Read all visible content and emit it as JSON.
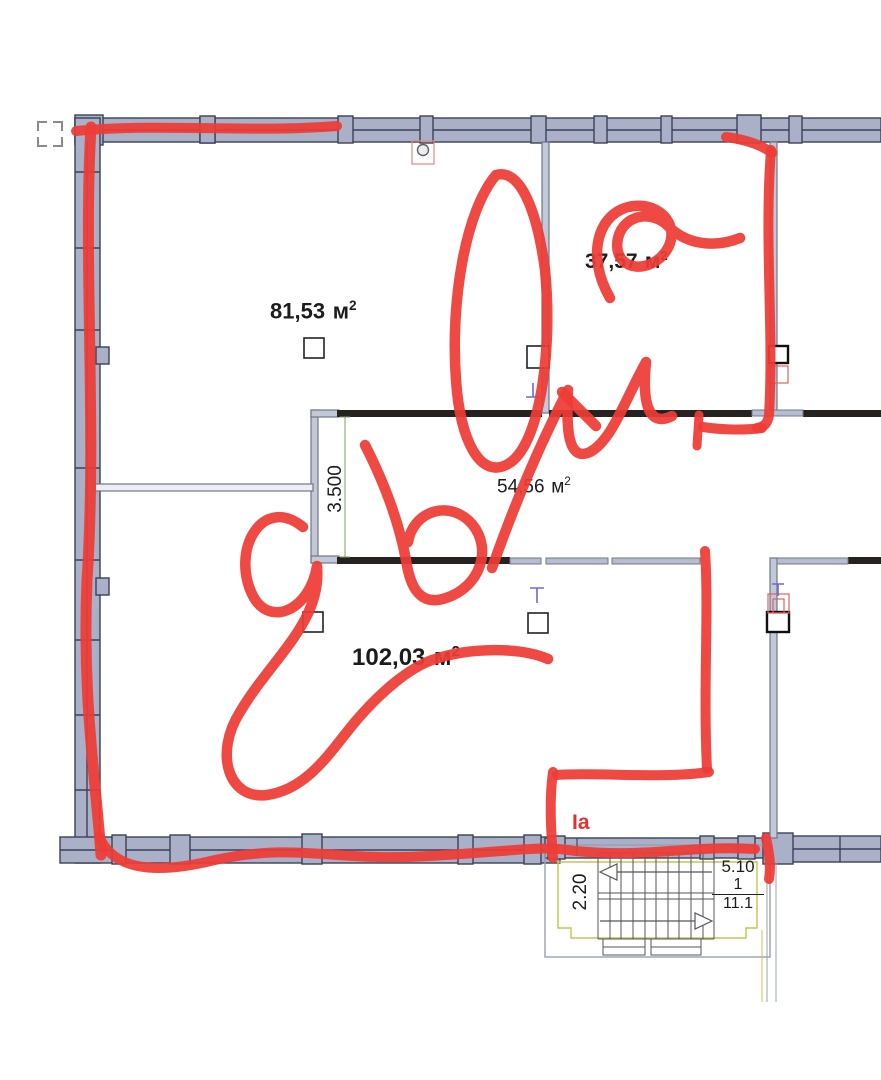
{
  "plan": {
    "unit": {
      "base": "м",
      "exp": "2"
    },
    "rooms": [
      {
        "id": "room-top-left",
        "area_value": "81,53"
      },
      {
        "id": "room-top-right",
        "area_value": "37,57"
      },
      {
        "id": "corridor",
        "area_value": "54,56"
      },
      {
        "id": "room-bottom-large",
        "area_value": "102,03"
      }
    ],
    "corridor_dimension": "3.500",
    "stairwell": {
      "width": "2.20",
      "run": "5.10",
      "flight": "1",
      "total": "11.1"
    }
  },
  "red_markup": {
    "handwritten_text": "260 м2",
    "section_label": "Ia"
  },
  "icons": [
    "crop-mark-icon",
    "outlet-icon",
    "column-marker",
    "panel-icon",
    "tee-mark-icon"
  ],
  "colors": {
    "wall_fill": "#a9b0c8",
    "wall_outline": "#3b4156",
    "partition_fill": "#b7bdcf",
    "partition_outline": "#70768c",
    "dark_wall": "#262220",
    "red_marker": "#ee3b36",
    "red_label": "#e23230",
    "stair_outline_yellow": "#c5c54e",
    "dimension_green": "#7fa060",
    "symbol_blue": "#6a6ad0"
  }
}
